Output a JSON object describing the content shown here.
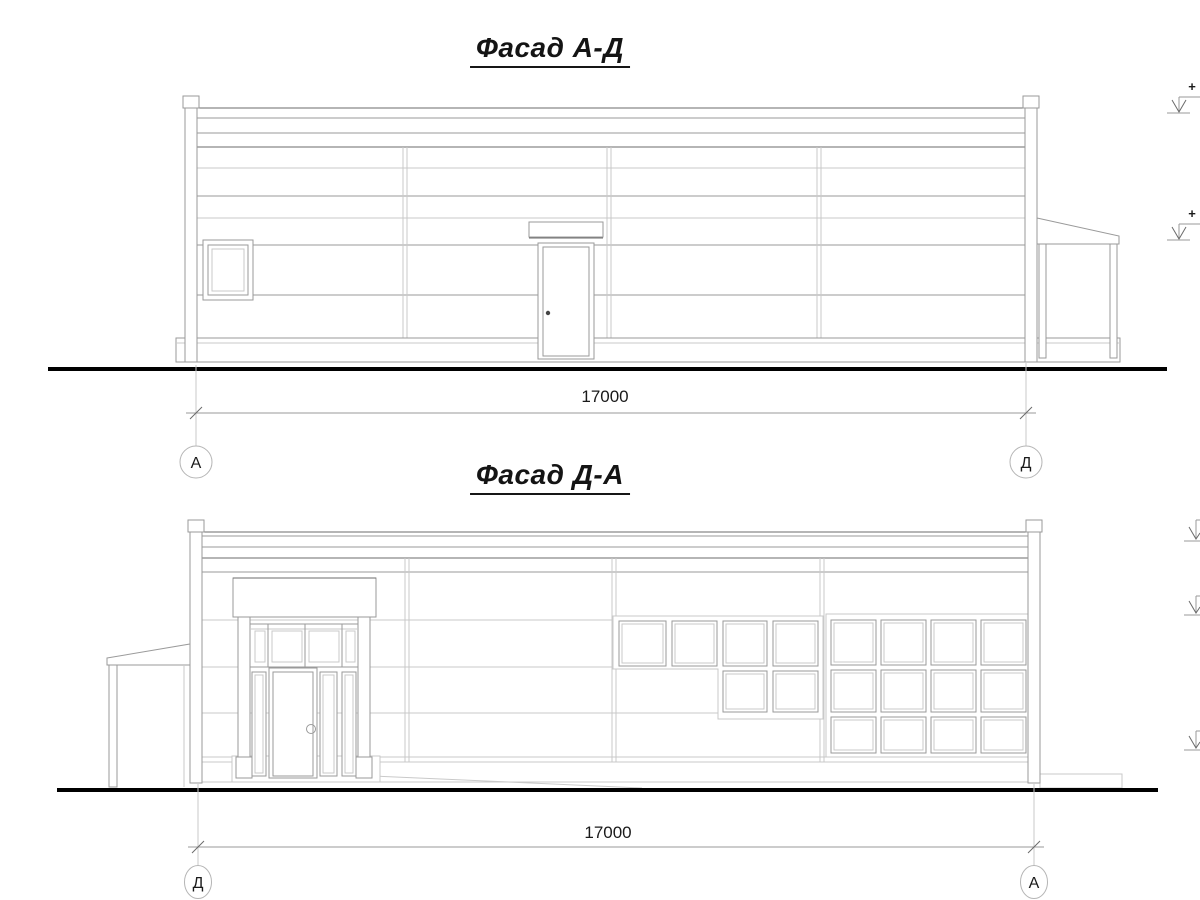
{
  "page": {
    "background": "#ffffff"
  },
  "facade_ad": {
    "title": "Фасад А-Д",
    "dimension_value": "17000",
    "axis_left_label": "А",
    "axis_right_label": "Д",
    "elevation_marks": [
      {
        "sign": "+"
      },
      {
        "sign": "+"
      }
    ]
  },
  "facade_da": {
    "title": "Фасад Д-А",
    "dimension_value": "17000",
    "axis_left_label": "Д",
    "axis_right_label": "А"
  },
  "colors": {
    "line_dark": "#6b6b6b",
    "line_medium": "#9a9a9a",
    "line_light": "#c9c9c9",
    "ground": "#000000",
    "text": "#1a1a1a"
  }
}
